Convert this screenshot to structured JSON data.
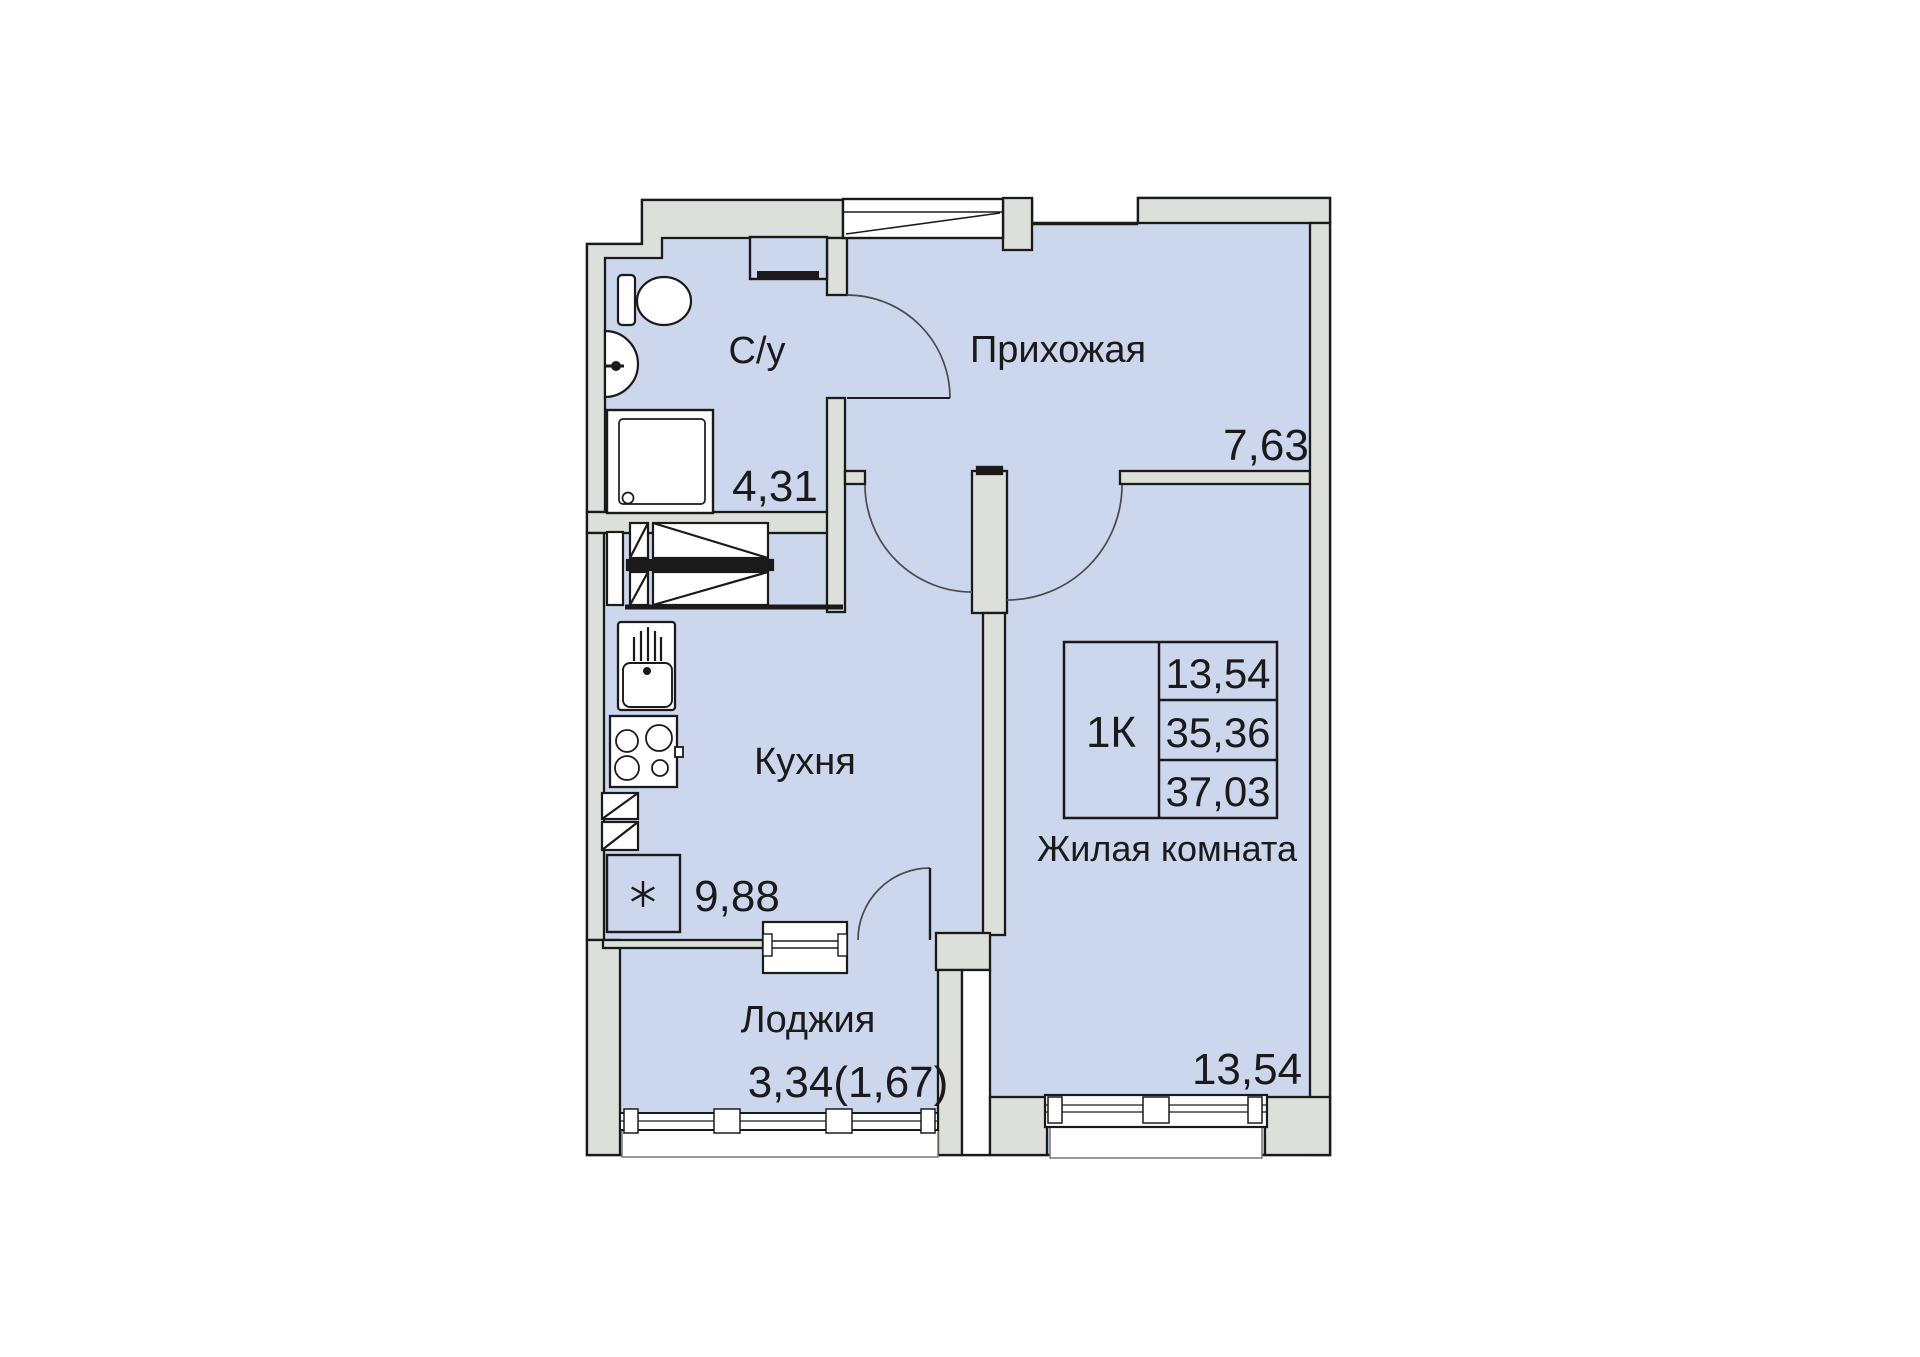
{
  "plan": {
    "title": "apartment floor plan",
    "unit": {
      "type_label": "1К",
      "living_area": "13,54",
      "area_without_loggia": "35,36",
      "total_area": "37,03"
    },
    "rooms": [
      {
        "id": "bathroom",
        "label": "С/у",
        "area": "4,31"
      },
      {
        "id": "hallway",
        "label": "Прихожая",
        "area": "7,63"
      },
      {
        "id": "kitchen",
        "label": "Кухня",
        "area": "9,88"
      },
      {
        "id": "living-room",
        "label": "Жилая комната",
        "area": "13,54"
      },
      {
        "id": "loggia",
        "label": "Лоджия",
        "area": "3,34(1,67)"
      }
    ],
    "fixtures": [
      "toilet",
      "washbasin",
      "shower-cabin",
      "water-heater",
      "wardrobe",
      "kitchen-sink",
      "stove",
      "fridge",
      "entrance-door",
      "balcony-door",
      "window",
      "loggia-glazing"
    ],
    "colors": {
      "floor": "#ccd6ec",
      "wall": "#dcdfda",
      "outline": "#1a1a1a",
      "background": "#ffffff",
      "text": "#1a1a1a"
    }
  }
}
